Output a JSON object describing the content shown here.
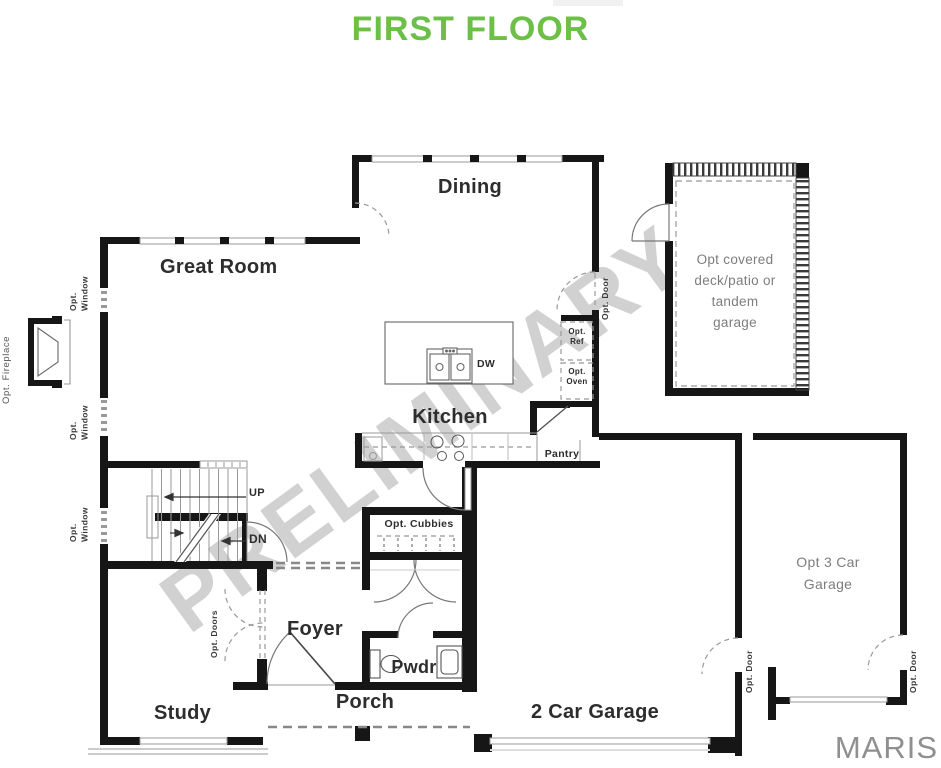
{
  "title": "FIRST FLOOR",
  "watermark": "PRELIMINARY",
  "brand": "MARIS",
  "colors": {
    "title_green": "#6cbf47",
    "wall_black": "#161616",
    "label_dark": "#2d2d2d",
    "label_gray": "#7d7d7d",
    "watermark_gray": "#c9c9c9",
    "maris_gray": "#8f8f8f"
  },
  "rooms": {
    "great_room": "Great Room",
    "dining": "Dining",
    "kitchen": "Kitchen",
    "foyer": "Foyer",
    "study": "Study",
    "porch": "Porch",
    "powder": "Pwdr",
    "pantry": "Pantry",
    "garage": "2 Car Garage",
    "opt_garage": {
      "line1": "Opt 3 Car",
      "line2": "Garage"
    },
    "deck": {
      "line1": "Opt covered",
      "line2": "deck/patio or",
      "line3": "tandem",
      "line4": "garage"
    }
  },
  "annotations": {
    "opt_window_word1": "Opt.",
    "opt_window_word2": "Window",
    "opt_fireplace": "Opt. Fireplace",
    "opt_door": "Opt. Door",
    "opt_doors": "Opt. Doors",
    "opt_cubbies": "Opt. Cubbies",
    "opt_ref_l1": "Opt.",
    "opt_ref_l2": "Ref",
    "opt_oven_l1": "Opt.",
    "opt_oven_l2": "Oven",
    "dishwasher": "DW",
    "up": "UP",
    "down": "DN"
  }
}
